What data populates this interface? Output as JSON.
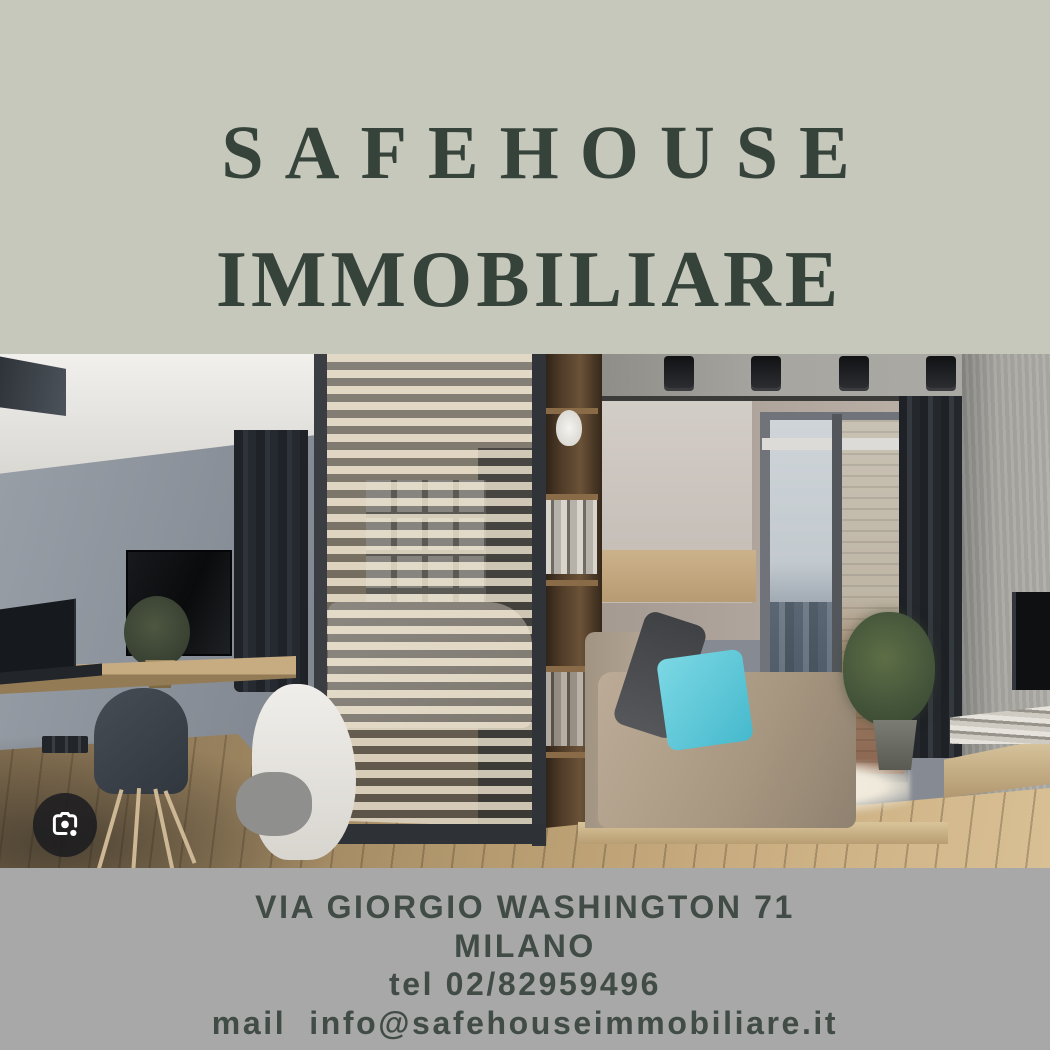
{
  "header": {
    "title_line1": "SAFEHOUSE",
    "title_line2": "IMMOBILIARE"
  },
  "footer": {
    "address_line": "VIA GIORGIO WASHINGTON 71",
    "city_line": "MILANO",
    "phone_line": "tel 02/82959496",
    "email_line": "mail  info@safehouseimmobiliare.it"
  },
  "photo": {
    "description": "Modern studio apartment interior: gray wall with mounted TV, floating wooden desk with laptop and chair, wooden slat room divider hiding a white bed, dark shelving column, daybed with taupe cushions and a turquoise pillow, balcony glass door with brick wall and city view, dark curtains, concrete wall with second TV, wooden floor",
    "accent_pillow_color": "#55c7d8"
  },
  "icons": {
    "lens_button": "google-lens-icon"
  },
  "colors": {
    "top_background": "#c7c8bc",
    "bottom_background": "#a8a8a8",
    "title_text": "#36433b",
    "contact_text": "#414c46",
    "lens_button_background": "#1c1d20"
  }
}
